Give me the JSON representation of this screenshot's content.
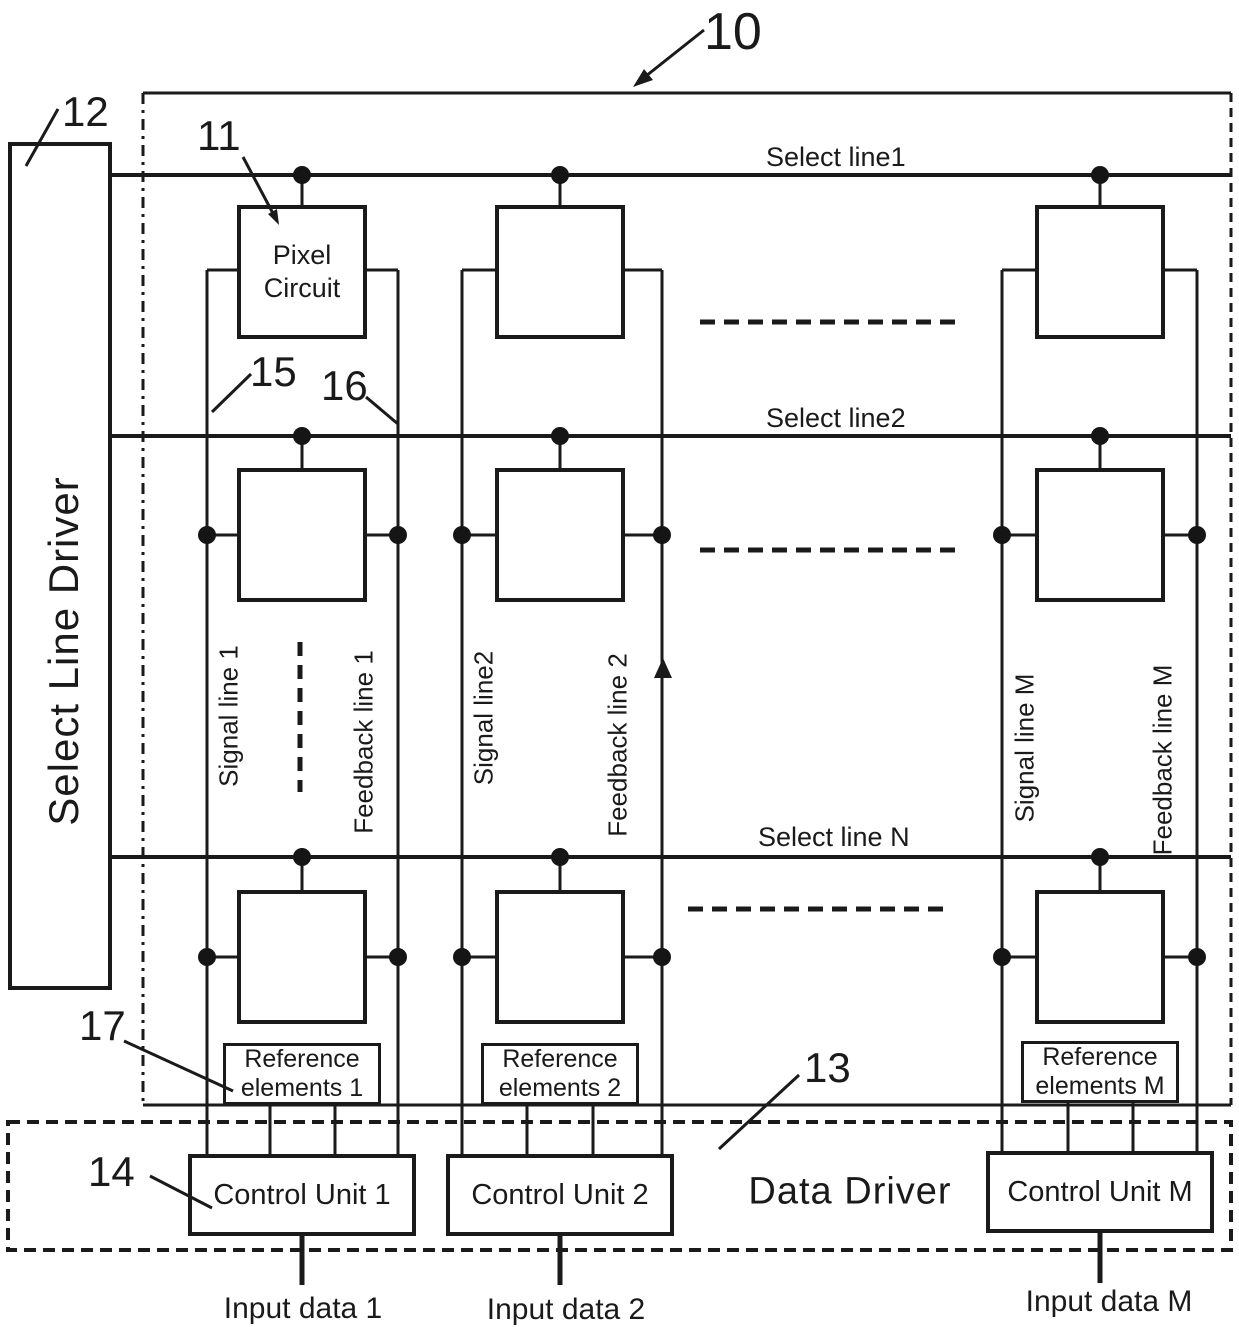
{
  "callouts": {
    "display_panel": "10",
    "pixel_circuit": "11",
    "select_line_driver": "12",
    "data_driver": "13",
    "control_unit": "14",
    "signal_line": "15",
    "feedback_line": "16",
    "reference_elements": "17"
  },
  "select_line_driver_label": "Select Line Driver",
  "select_lines": {
    "row1": "Select line1",
    "row2": "Select line2",
    "rowN": "Select line N"
  },
  "pixel_circuit_label": "Pixel Circuit",
  "columns": [
    {
      "signal_line": "Signal line 1",
      "feedback_line": "Feedback line 1",
      "reference_elements": "Reference elements 1",
      "control_unit": "Control Unit 1",
      "input_data": "Input data 1"
    },
    {
      "signal_line": "Signal line2",
      "feedback_line": "Feedback line 2",
      "reference_elements": "Reference elements 2",
      "control_unit": "Control Unit 2",
      "input_data": "Input data 2"
    },
    {
      "signal_line": "Signal line M",
      "feedback_line": "Feedback line M",
      "reference_elements": "Reference elements M",
      "control_unit": "Control Unit M",
      "input_data": "Input data M"
    }
  ],
  "data_driver_label": "Data Driver",
  "colors": {
    "ink": "#1a1a1a",
    "background": "#ffffff"
  }
}
